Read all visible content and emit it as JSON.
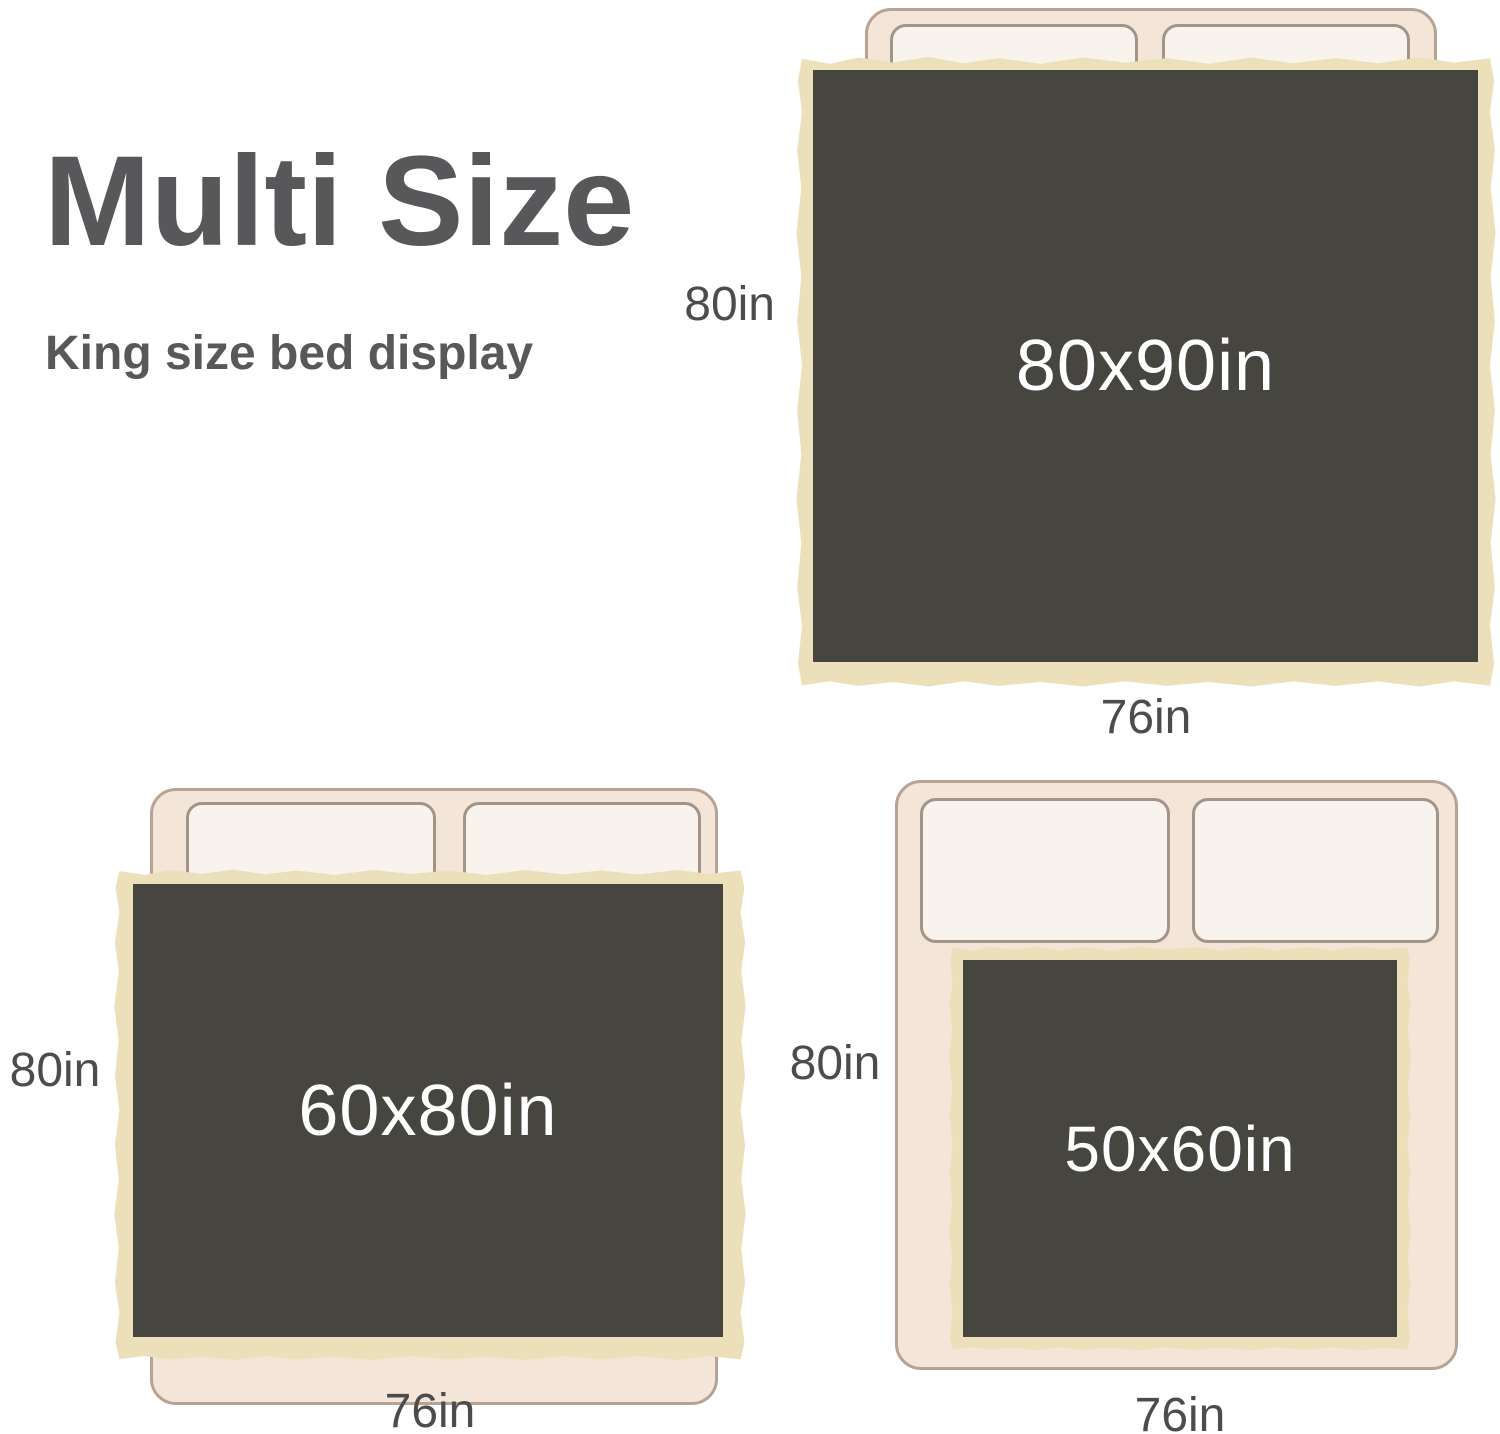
{
  "title": "Multi Size",
  "subtitle": "King size bed display",
  "colors": {
    "heading_text": "#58585b",
    "dimension_text": "#4c4c4e",
    "blanket_face": "#474540",
    "blanket_trim": "#ece0bb",
    "bed_frame": "#f3e5d7",
    "bed_frame_border": "#b7a394",
    "pillow": "#f8f3ed",
    "pillow_border": "#a3948a",
    "size_label_text": "#ffffff"
  },
  "diagrams": [
    {
      "name": "king-bed-with-80x90-blanket",
      "size_label": "80x90in",
      "height_label": "80in",
      "width_label": "76in"
    },
    {
      "name": "king-bed-with-60x80-blanket",
      "size_label": "60x80in",
      "height_label": "80in",
      "width_label": "76in"
    },
    {
      "name": "king-bed-with-50x60-blanket",
      "size_label": "50x60in",
      "height_label": "80in",
      "width_label": "76in"
    }
  ]
}
